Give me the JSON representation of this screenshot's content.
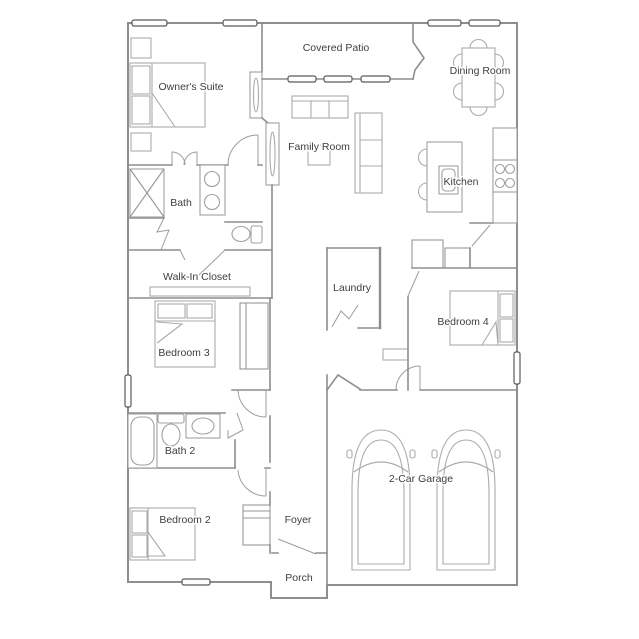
{
  "plan": {
    "title": "Single-story house floor plan",
    "colors": {
      "background": "#ffffff",
      "wall": "#8e8e8e",
      "furniture": "#ababab",
      "window": "#5a5a5a",
      "label_text": "#3e3e3e"
    },
    "rooms": [
      {
        "id": "owners-suite",
        "label": "Owner's Suite"
      },
      {
        "id": "covered-patio",
        "label": "Covered Patio"
      },
      {
        "id": "dining-room",
        "label": "Dining Room"
      },
      {
        "id": "family-room",
        "label": "Family Room"
      },
      {
        "id": "kitchen",
        "label": "Kitchen"
      },
      {
        "id": "bath",
        "label": "Bath"
      },
      {
        "id": "walk-in-closet",
        "label": "Walk-In Closet"
      },
      {
        "id": "laundry",
        "label": "Laundry"
      },
      {
        "id": "bedroom-4",
        "label": "Bedroom 4"
      },
      {
        "id": "bedroom-3",
        "label": "Bedroom 3"
      },
      {
        "id": "bath-2",
        "label": "Bath 2"
      },
      {
        "id": "bedroom-2",
        "label": "Bedroom 2"
      },
      {
        "id": "foyer",
        "label": "Foyer"
      },
      {
        "id": "porch",
        "label": "Porch"
      },
      {
        "id": "garage",
        "label": "2-Car Garage"
      }
    ]
  }
}
